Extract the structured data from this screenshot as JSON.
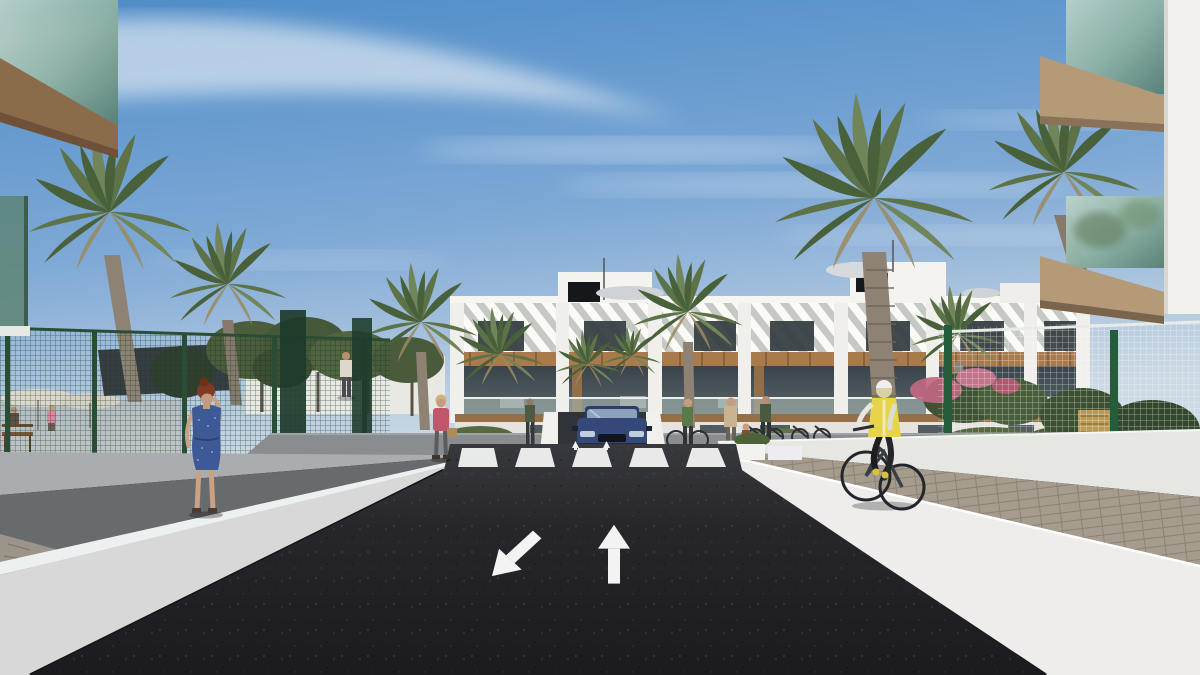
{
  "scene": {
    "description": "Architectural 3D rendering of a modern white apartment complex street view: dark asphalt two-way road with painted lane arrows leading to a zebra crosswalk, flanked by white retaining walls and walkways, palm trees, green mesh fences, pedestrians and a cyclist under a blue sky",
    "road_markings": {
      "arrow_left_lane": "toward-viewer (down-left)",
      "arrow_right_lane": "away (straight ahead)",
      "crosswalk_stripes": 5
    },
    "objects": [
      "sky-with-clouds",
      "central-apartment-building",
      "left-foreground-balcony",
      "right-foreground-balcony",
      "palm-trees",
      "leafy-trees",
      "green-mesh-fence-left",
      "white-mesh-fence-right",
      "shade-sail",
      "terrace-umbrellas",
      "left-retaining-wall",
      "right-retaining-wall",
      "paver-path-right",
      "walkway-left",
      "asphalt-road",
      "zebra-crosswalk",
      "lane-arrows",
      "garage-ramp",
      "dark-blue-car",
      "woman-blue-dress",
      "woman-pink-jacket",
      "distant-man",
      "distant-figure",
      "cyclist-yellow-vest",
      "pedestrian-group",
      "parked-bicycles",
      "bougainvillea-shrubs",
      "rooftop-vents",
      "rooftop-parasols",
      "wooden-bench"
    ],
    "people_count": 9,
    "vehicles": [
      "dark-blue-car",
      "bicycle-ridden",
      "bicycles-parked"
    ]
  },
  "palette": {
    "sky-top": "#4e8cc8",
    "sky-mid": "#7fa9d6",
    "sky-low": "#cdd9e4",
    "cloud": "#f2f5f7",
    "facade-white": "#f0efeb",
    "facade-shade": "#d9d8d3",
    "louver-base": "#c6c9c3",
    "window-dark": "#333c40",
    "wood": "#a87a4c",
    "wood-dark": "#7c5a38",
    "glass-teal": "#8fb3a6",
    "glass-deep": "#577f72",
    "palm1": "#5d7247",
    "palm2": "#71855a",
    "palm3": "#49613a",
    "trunk": "#8d8273",
    "tree-green": "#4c5c3c",
    "fence-green": "#2a4d36",
    "asphalt-hi": "#38393e",
    "asphalt-lo": "#1b1b1f",
    "marking-white": "#f2f3f2",
    "wall-white": "#eeedeb",
    "wall-shade": "#d7d8d7",
    "path-gray": "#676b6e",
    "paver": "#a59c8e",
    "car-blue": "#35487a",
    "car-roof": "#2c3c66",
    "vest-yellow": "#e8d44a",
    "dress-blue": "#3e5a96",
    "jacket-pink": "#c2566a",
    "skin": "#c79c80",
    "hair-red": "#7e3a22",
    "flower-pink": "#c06880"
  }
}
